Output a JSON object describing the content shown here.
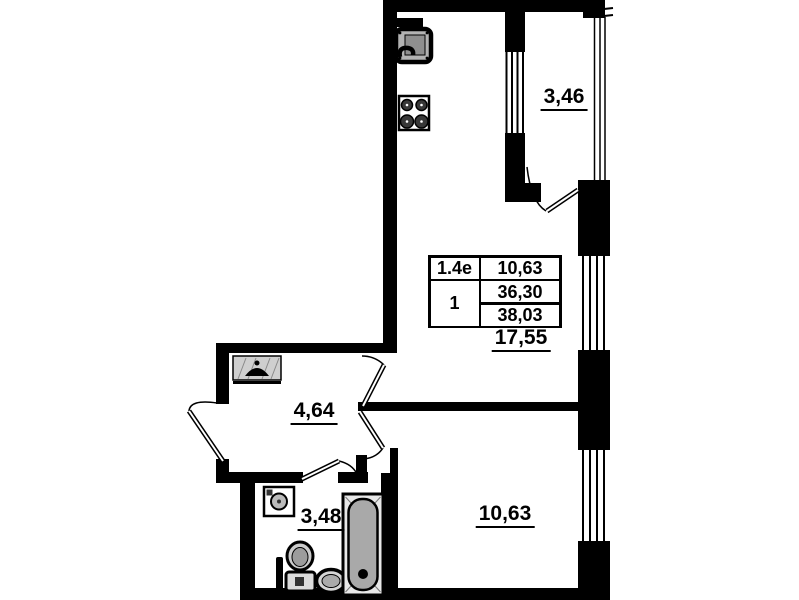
{
  "stamp_table": {
    "flat_type": "1.4e",
    "rooms_count": "1",
    "living_area": "10,63",
    "area_without_balcony": "36,30",
    "total_area": "38,03"
  },
  "room_labels": {
    "balcony": "3,46",
    "kitchen_living": "17,55",
    "hallway": "4,64",
    "bathroom": "3,48",
    "bedroom": "10,63"
  },
  "fixtures": [
    "kitchen-sink",
    "stove",
    "ventilation-duct",
    "wardrobe",
    "washing-machine",
    "towel-pipe",
    "toilet",
    "wash-basin",
    "bathtub"
  ],
  "colors": {
    "wall": "#000000",
    "background": "#ffffff",
    "fixture_gray": "#a9a9a9"
  }
}
